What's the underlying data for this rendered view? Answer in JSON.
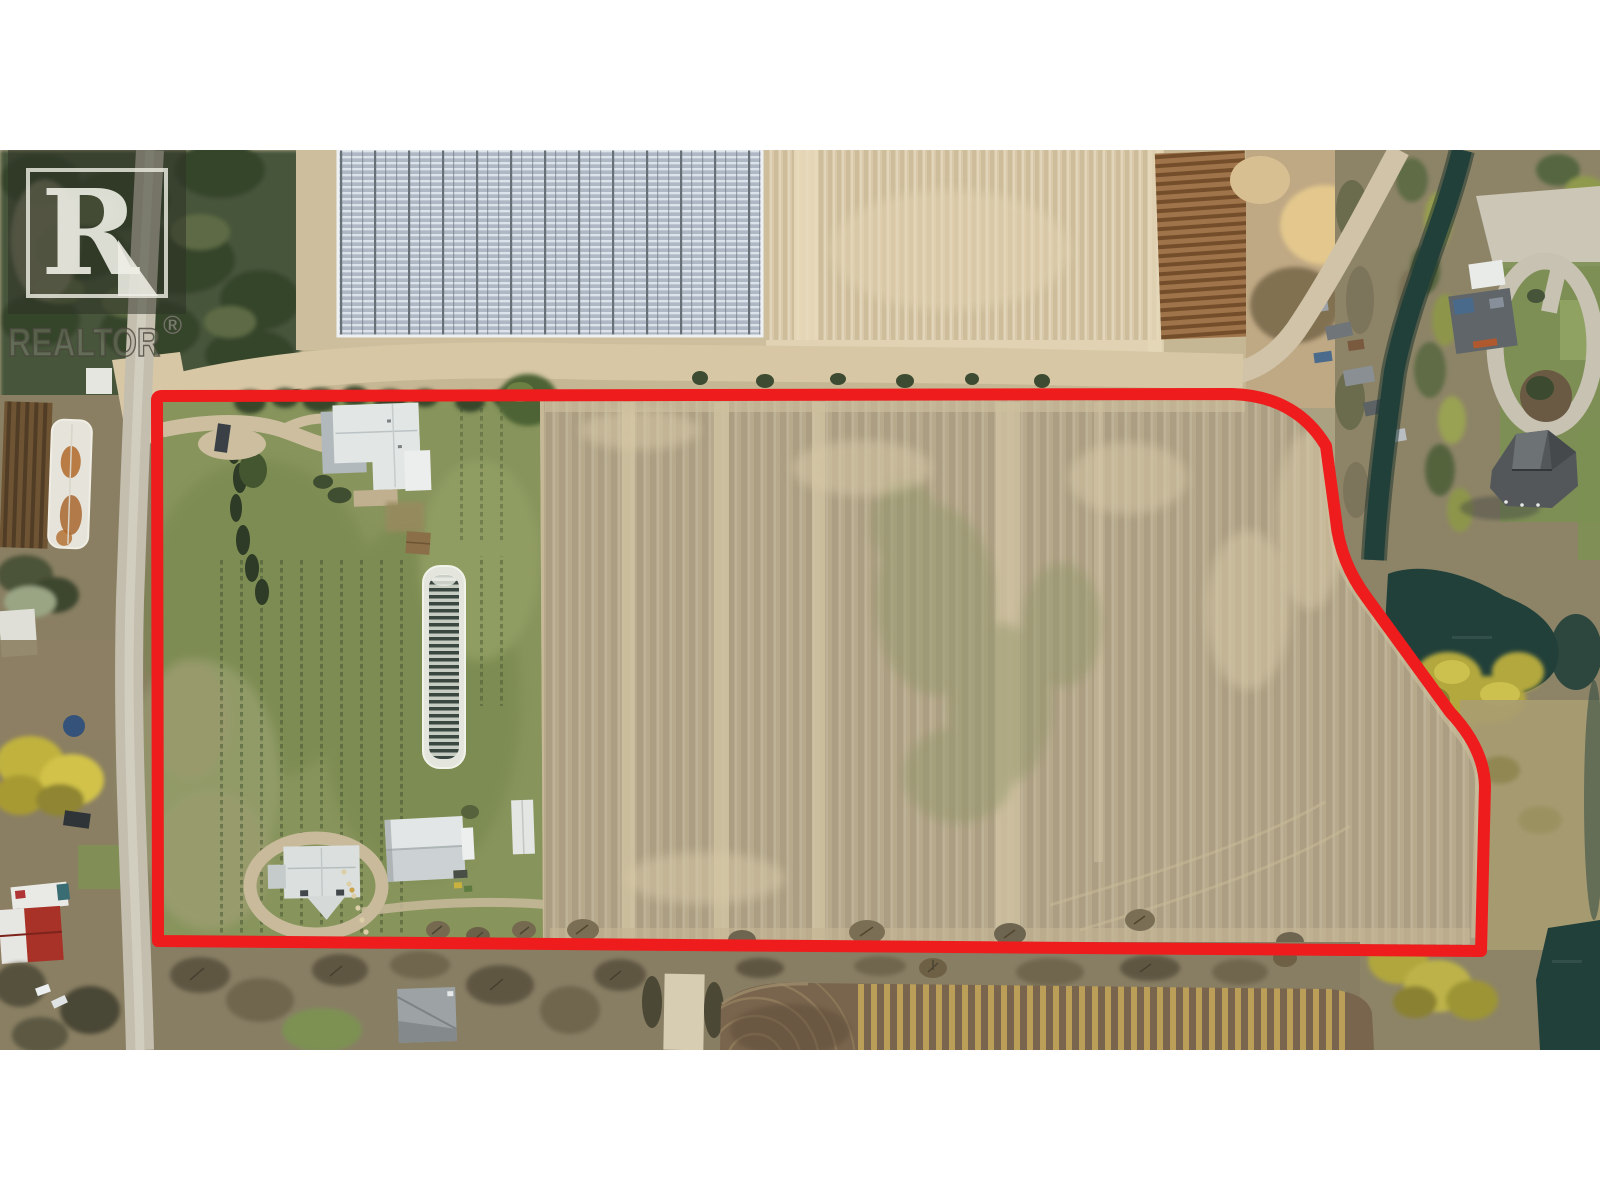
{
  "watermark": {
    "brand": "REALTOR",
    "registered_symbol": "®",
    "logo_letter": "R"
  },
  "colors": {
    "boundary_red": "#ee1c1c",
    "letterbox_white": "#ffffff",
    "field_tan": "#b7aa8c",
    "top_field_tan": "#d9c9a8",
    "yard_green": "#87945c",
    "water_teal": "#22403a",
    "greenhouse_blue": "#c2c9d3",
    "road_gray": "#c4beaf",
    "dirt_road_tan": "#d7c7a5",
    "plowed_brown": "#79654d",
    "stubble_yellow": "#c2a659",
    "autumn_yellow": "#b3a83c",
    "roof_white": "#e2e6e5",
    "roof_dark_gray": "#53575a",
    "barn_red": "#a83228"
  }
}
